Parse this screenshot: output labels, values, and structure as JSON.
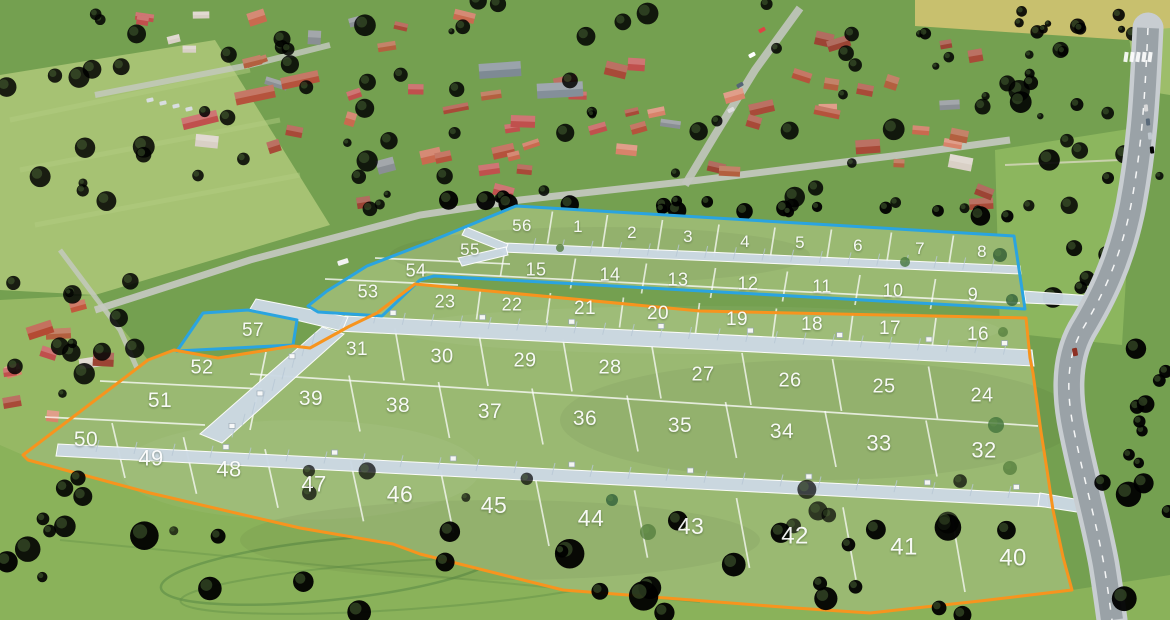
{
  "map": {
    "description": "Aerial land-plot development plan with numbered parcels",
    "label_color": "#ffffff",
    "total_plots": 57,
    "phases": [
      {
        "id": "phase1",
        "outline_color": "#2aa4e0",
        "plots": [
          1,
          2,
          3,
          4,
          5,
          6,
          7,
          8,
          9,
          10,
          11,
          12,
          13,
          14,
          15,
          53,
          54,
          55,
          56,
          57
        ]
      },
      {
        "id": "phase2",
        "outline_color": "#f7941e",
        "plots": [
          16,
          17,
          18,
          19,
          20,
          21,
          22,
          23,
          24,
          25,
          26,
          27,
          28,
          29,
          30,
          31,
          32,
          33,
          34,
          35,
          36,
          37,
          38,
          39,
          40,
          41,
          42,
          43,
          44,
          45,
          46,
          47,
          48,
          49,
          50,
          51,
          52
        ]
      }
    ],
    "plots": [
      {
        "n": 1,
        "x": 578,
        "y": 228,
        "phase": "phase1"
      },
      {
        "n": 2,
        "x": 632,
        "y": 234,
        "phase": "phase1"
      },
      {
        "n": 3,
        "x": 688,
        "y": 238,
        "phase": "phase1"
      },
      {
        "n": 4,
        "x": 745,
        "y": 243,
        "phase": "phase1"
      },
      {
        "n": 5,
        "x": 800,
        "y": 244,
        "phase": "phase1"
      },
      {
        "n": 6,
        "x": 858,
        "y": 247,
        "phase": "phase1"
      },
      {
        "n": 7,
        "x": 920,
        "y": 250,
        "phase": "phase1"
      },
      {
        "n": 8,
        "x": 982,
        "y": 253,
        "phase": "phase1"
      },
      {
        "n": 9,
        "x": 973,
        "y": 296,
        "phase": "phase1"
      },
      {
        "n": 10,
        "x": 893,
        "y": 292,
        "phase": "phase1"
      },
      {
        "n": 11,
        "x": 822,
        "y": 288,
        "phase": "phase1"
      },
      {
        "n": 12,
        "x": 748,
        "y": 285,
        "phase": "phase1"
      },
      {
        "n": 13,
        "x": 678,
        "y": 281,
        "phase": "phase1"
      },
      {
        "n": 14,
        "x": 610,
        "y": 276,
        "phase": "phase1"
      },
      {
        "n": 15,
        "x": 536,
        "y": 271,
        "phase": "phase1"
      },
      {
        "n": 16,
        "x": 978,
        "y": 336,
        "phase": "phase2"
      },
      {
        "n": 17,
        "x": 890,
        "y": 330,
        "phase": "phase2"
      },
      {
        "n": 18,
        "x": 812,
        "y": 326,
        "phase": "phase2"
      },
      {
        "n": 19,
        "x": 737,
        "y": 321,
        "phase": "phase2"
      },
      {
        "n": 20,
        "x": 658,
        "y": 315,
        "phase": "phase2"
      },
      {
        "n": 21,
        "x": 585,
        "y": 310,
        "phase": "phase2"
      },
      {
        "n": 22,
        "x": 512,
        "y": 306,
        "phase": "phase2"
      },
      {
        "n": 23,
        "x": 445,
        "y": 303,
        "phase": "phase2"
      },
      {
        "n": 24,
        "x": 982,
        "y": 397,
        "phase": "phase2"
      },
      {
        "n": 25,
        "x": 884,
        "y": 388,
        "phase": "phase2"
      },
      {
        "n": 26,
        "x": 790,
        "y": 382,
        "phase": "phase2"
      },
      {
        "n": 27,
        "x": 703,
        "y": 376,
        "phase": "phase2"
      },
      {
        "n": 28,
        "x": 610,
        "y": 369,
        "phase": "phase2"
      },
      {
        "n": 29,
        "x": 525,
        "y": 362,
        "phase": "phase2"
      },
      {
        "n": 30,
        "x": 442,
        "y": 358,
        "phase": "phase2"
      },
      {
        "n": 31,
        "x": 357,
        "y": 351,
        "phase": "phase2"
      },
      {
        "n": 32,
        "x": 984,
        "y": 452,
        "phase": "phase2"
      },
      {
        "n": 33,
        "x": 879,
        "y": 445,
        "phase": "phase2"
      },
      {
        "n": 34,
        "x": 782,
        "y": 433,
        "phase": "phase2"
      },
      {
        "n": 35,
        "x": 680,
        "y": 427,
        "phase": "phase2"
      },
      {
        "n": 36,
        "x": 585,
        "y": 420,
        "phase": "phase2"
      },
      {
        "n": 37,
        "x": 490,
        "y": 413,
        "phase": "phase2"
      },
      {
        "n": 38,
        "x": 398,
        "y": 407,
        "phase": "phase2"
      },
      {
        "n": 39,
        "x": 311,
        "y": 400,
        "phase": "phase2"
      },
      {
        "n": 40,
        "x": 1013,
        "y": 560,
        "phase": "phase2"
      },
      {
        "n": 41,
        "x": 904,
        "y": 549,
        "phase": "phase2"
      },
      {
        "n": 42,
        "x": 795,
        "y": 538,
        "phase": "phase2"
      },
      {
        "n": 43,
        "x": 691,
        "y": 528,
        "phase": "phase2"
      },
      {
        "n": 44,
        "x": 591,
        "y": 520,
        "phase": "phase2"
      },
      {
        "n": 45,
        "x": 494,
        "y": 507,
        "phase": "phase2"
      },
      {
        "n": 46,
        "x": 400,
        "y": 496,
        "phase": "phase2"
      },
      {
        "n": 47,
        "x": 314,
        "y": 486,
        "phase": "phase2"
      },
      {
        "n": 48,
        "x": 229,
        "y": 471,
        "phase": "phase2"
      },
      {
        "n": 49,
        "x": 151,
        "y": 460,
        "phase": "phase2"
      },
      {
        "n": 50,
        "x": 86,
        "y": 441,
        "phase": "phase2"
      },
      {
        "n": 51,
        "x": 160,
        "y": 402,
        "phase": "phase2"
      },
      {
        "n": 52,
        "x": 202,
        "y": 369,
        "phase": "phase2"
      },
      {
        "n": 53,
        "x": 368,
        "y": 293,
        "phase": "phase1"
      },
      {
        "n": 54,
        "x": 416,
        "y": 272,
        "phase": "phase1"
      },
      {
        "n": 55,
        "x": 470,
        "y": 251,
        "phase": "phase1"
      },
      {
        "n": 56,
        "x": 522,
        "y": 227,
        "phase": "phase1"
      },
      {
        "n": 57,
        "x": 253,
        "y": 332,
        "phase": "phase1"
      }
    ]
  }
}
